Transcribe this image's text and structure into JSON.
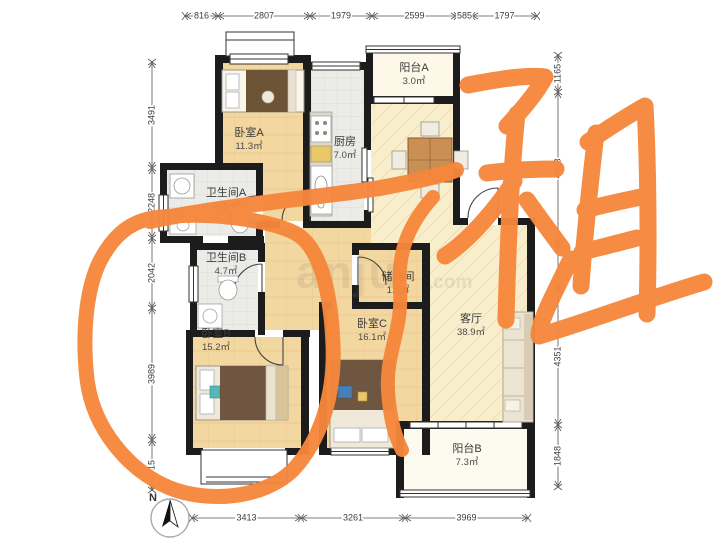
{
  "floorplan": {
    "rooms": [
      {
        "id": "bedroom-a",
        "name": "卧室A",
        "area": "11.3㎡",
        "label": {
          "x": 249,
          "y": 136
        }
      },
      {
        "id": "balcony-a",
        "name": "阳台A",
        "area": "3.0㎡",
        "label": {
          "x": 414,
          "y": 71
        }
      },
      {
        "id": "kitchen",
        "name": "厨房",
        "area": "7.0㎡",
        "label": {
          "x": 345,
          "y": 145
        }
      },
      {
        "id": "bathroom-a",
        "name": "卫生间A",
        "area": "5.1㎡",
        "label": {
          "x": 226,
          "y": 196
        }
      },
      {
        "id": "bathroom-b",
        "name": "卫生间B",
        "area": "4.7㎡",
        "label": {
          "x": 226,
          "y": 261
        }
      },
      {
        "id": "storage",
        "name": "储物间",
        "area": "1.7㎡",
        "label": {
          "x": 398,
          "y": 280
        }
      },
      {
        "id": "bedroom-b",
        "name": "卧室B",
        "area": "15.2㎡",
        "label": {
          "x": 216,
          "y": 337
        }
      },
      {
        "id": "bedroom-c",
        "name": "卧室C",
        "area": "16.1㎡",
        "label": {
          "x": 372,
          "y": 327
        }
      },
      {
        "id": "living-room",
        "name": "客厅",
        "area": "38.9㎡",
        "label": {
          "x": 471,
          "y": 322
        }
      },
      {
        "id": "balcony-b",
        "name": "阳台B",
        "area": "7.3㎡",
        "label": {
          "x": 467,
          "y": 452
        }
      }
    ],
    "dimensions": {
      "top": {
        "axis": "x",
        "line": 16,
        "ticks": [
          185,
          218,
          310,
          372,
          457,
          472,
          537
        ],
        "labels": [
          "816",
          "2807",
          "1979",
          "2599",
          "585",
          "1797"
        ]
      },
      "left": {
        "axis": "y",
        "line": 152,
        "ticks": [
          62,
          168,
          238,
          308,
          440,
          490
        ],
        "labels": [
          "3491",
          "2248",
          "2042",
          "3989",
          "15"
        ]
      },
      "right": {
        "axis": "y",
        "line": 558,
        "ticks": [
          55,
          92,
          245,
          288,
          425,
          487
        ],
        "labels": [
          "1165",
          "4823",
          "",
          "4351",
          "1848"
        ]
      },
      "bottom": {
        "axis": "x",
        "line": 518,
        "ticks": [
          192,
          301,
          405,
          528
        ],
        "labels": [
          "3413",
          "3261",
          "3969"
        ]
      }
    },
    "compass": {
      "label": "N"
    },
    "watermark": {
      "text": "anju",
      "suffix": ".com"
    }
  },
  "annotations": {
    "color": "#F6873C",
    "handwritten_character": "租",
    "circled_room": "卧室B"
  }
}
